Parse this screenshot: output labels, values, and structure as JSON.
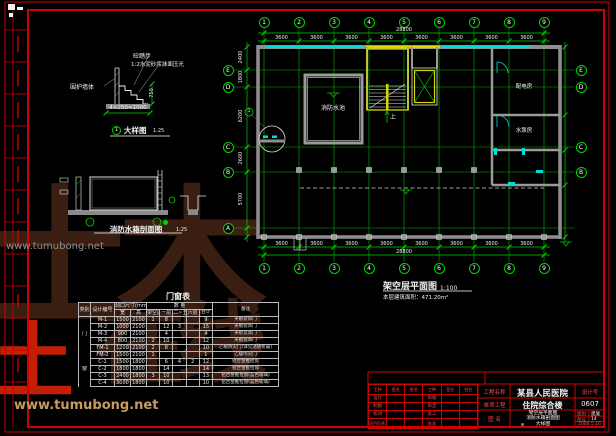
{
  "watermark": {
    "logo_text_1": "土木",
    "logo_text_2": "在线",
    "logo_text_red": "土",
    "url_text": "www.tumubong.net"
  },
  "detail": {
    "label_step": "砼踏步",
    "label_finish": "1:2水泥砂浆抹面压光",
    "label_wall": "围护墙体",
    "dim_h": "4×250=1000",
    "dim_v": "750",
    "bubble_no": "1",
    "caption": "大样图",
    "scale": "1:25",
    "callout_no": "1"
  },
  "section": {
    "caption": "消防水箱剖面图",
    "scale": "1:25"
  },
  "plan": {
    "title": "架空层平面图",
    "scale": "1:100",
    "area_note": "本层建筑面积：471.20m²",
    "axis_top": [
      "1",
      "2",
      "3",
      "4",
      "5",
      "6",
      "7",
      "8",
      "9"
    ],
    "axis_bottom": [
      "1",
      "2",
      "3",
      "4",
      "5",
      "6",
      "7",
      "8",
      "9"
    ],
    "axis_left": [
      "E",
      "D",
      "C",
      "B",
      "A"
    ],
    "axis_right": [
      "E",
      "D",
      "C",
      "B"
    ],
    "top_bay_dims": [
      "3600",
      "3600",
      "3600",
      "3600",
      "3600",
      "3600",
      "3600",
      "3600"
    ],
    "top_total": "28800",
    "bottom_bay_dims": [
      "3600",
      "3600",
      "3600",
      "3600",
      "3600",
      "3600",
      "3600",
      "3600"
    ],
    "bottom_total": "28800",
    "left_dims": [
      "2400",
      "1800",
      "6200",
      "2600",
      "5700"
    ],
    "rooms": {
      "pool": "消防水池",
      "power": "配电房",
      "pump": "水泵房"
    },
    "stair_up": "上"
  },
  "table": {
    "title": "门窗表",
    "h_cat": "类别",
    "h_code": "设计编号",
    "h_size": "洞口尺寸(mm)",
    "h_qty": "数 量",
    "h_remark": "备注",
    "header_row2": [
      "宽",
      "高",
      "架空层",
      "一层",
      "二~五层",
      "六层",
      "合计"
    ],
    "rows": [
      {
        "cat": "",
        "cells": [
          "M-1",
          "1500",
          "2100",
          "1",
          "8",
          "",
          "",
          "9",
          "夹板装饰门"
        ]
      },
      {
        "cat": "",
        "cells": [
          "M-2",
          "1000",
          "2100",
          "",
          "12",
          "3",
          "",
          "15",
          "夹板装饰门"
        ]
      },
      {
        "cat": "门",
        "cells": [
          "M-3",
          "900",
          "2100",
          "",
          "4",
          "",
          "",
          "4",
          "夹板装饰门"
        ]
      },
      {
        "cat": "",
        "cells": [
          "M-4",
          "800",
          "2100",
          "2",
          "10",
          "",
          "",
          "12",
          "夹板装饰门"
        ]
      },
      {
        "cat": "",
        "cells": [
          "FM-1",
          "1200",
          "2100",
          "2",
          "8",
          "",
          "",
          "10",
          "乙级防火门(详见消防专篇)"
        ]
      },
      {
        "cat": "",
        "cells": [
          "FM-2",
          "1500",
          "2100",
          "1",
          "",
          "",
          "",
          "1",
          "乙级防火门"
        ]
      },
      {
        "cat": "",
        "cells": [
          "C-1",
          "1500",
          "1800",
          "",
          "6",
          "4",
          "2",
          "12",
          "铝合金推拉窗"
        ]
      },
      {
        "cat": "窗",
        "cells": [
          "C-2",
          "1800",
          "1800",
          "",
          "14",
          "",
          "",
          "14",
          "铝合金推拉窗"
        ]
      },
      {
        "cat": "",
        "cells": [
          "C-3",
          "2400",
          "1800",
          "3",
          "10",
          "",
          "",
          "13",
          "铝合金推拉窗(蓝色玻璃)"
        ]
      },
      {
        "cat": "",
        "cells": [
          "C-4",
          "3000",
          "1800",
          "",
          "10",
          "",
          "",
          "10",
          "铝合金推拉窗(蓝色玻璃)"
        ]
      }
    ]
  },
  "title_block": {
    "sig_headers": [
      "工种",
      "签名",
      "姓名",
      "工种",
      "签名",
      "姓名"
    ],
    "sig_rows": [
      [
        "设计",
        "",
        "",
        "审核",
        "",
        ""
      ],
      [
        "制图",
        "",
        "",
        "审定",
        "",
        ""
      ],
      [
        "校对",
        "",
        "",
        "总工",
        "",
        ""
      ],
      [
        "项目负责人",
        "",
        "",
        "批准",
        "",
        ""
      ]
    ],
    "label_project": "工程名称",
    "project": "某县人民医院",
    "label_sub": "单项工程",
    "sub_project": "住院综合楼",
    "label_design_no": "设计号",
    "design_no": "0607",
    "label_drawing": "图 名",
    "drawing_names": [
      "架空层平面图",
      "消防水箱剖面图",
      "大样图"
    ],
    "label_type": "图别",
    "type_value": "建施",
    "label_no": "图号",
    "no_value": "14",
    "date": "2006.5.16"
  }
}
